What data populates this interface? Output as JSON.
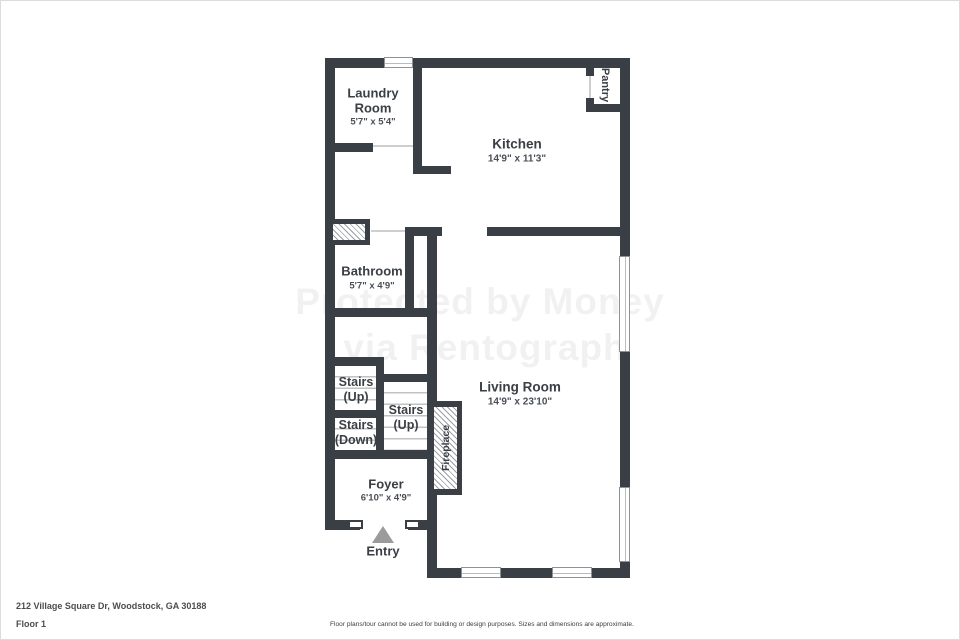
{
  "colors": {
    "wall": "#3a3f45",
    "label_text": "#3a3f45",
    "dimension_text": "#494f56",
    "stair_tread": "#c2c2c2",
    "entry_arrow": "#9b9b9b",
    "footer_text": "#4d4d4d"
  },
  "floorplan": {
    "laundry": {
      "line1": "Laundry",
      "line2": "Room",
      "dims": "5'7\" x 5'4\""
    },
    "kitchen": {
      "label": "Kitchen",
      "dims": "14'9\" x 11'3\""
    },
    "pantry": {
      "label": "Pantry"
    },
    "bathroom": {
      "label": "Bathroom",
      "dims": "5'7\" x 4'9\""
    },
    "stairs_up_left": {
      "line1": "Stairs",
      "line2": "(Up)"
    },
    "stairs_down": {
      "line1": "Stairs",
      "line2": "(Down)"
    },
    "stairs_up_right": {
      "line1": "Stairs",
      "line2": "(Up)"
    },
    "living": {
      "label": "Living Room",
      "dims": "14'9\" x 23'10\""
    },
    "fireplace": {
      "label": "Fireplace"
    },
    "foyer": {
      "label": "Foyer",
      "dims": "6'10\" x 4'9\""
    },
    "entry": {
      "label": "Entry"
    }
  },
  "watermark": {
    "line1": "Protected by Money",
    "line2": "via Rentograph"
  },
  "footer": {
    "address": "212 Village Square Dr, Woodstock, GA 30188",
    "floor": "Floor 1",
    "disclaimer": "Floor plans/tour cannot be used for building or design purposes. Sizes and dimensions are approximate."
  }
}
